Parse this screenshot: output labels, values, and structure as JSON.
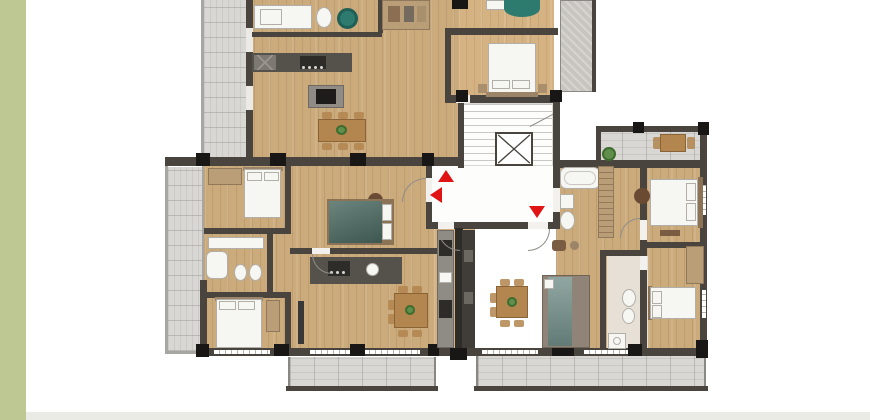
{
  "page": {
    "kind": "real-estate listing floor plan image",
    "visible_text": ""
  },
  "colors": {
    "pagebg": "#ffffff",
    "leftbar": "#bec893",
    "footer": "#ebebe6",
    "wood": "#cbaa7c",
    "balcony": "#d8d7d4",
    "wall": "#49453e",
    "rail": "#a8a6a2",
    "column": "#191715",
    "fixture": "#f6f6f3",
    "fixborder": "#b2afa9",
    "stair": "#c9c8c5",
    "hallfloor": "#fdfdfc",
    "teal": "#2d7a6e",
    "tealbed": "#4b6a61",
    "sofateal": "#74908a",
    "sofabase": "#8f8477",
    "table": "#b3854f",
    "wardrobe": "#b99e78",
    "plant": "#5f8f4a",
    "rugbrown": "#6b4a34",
    "arrow": "#e11414",
    "concrete": "#c8c5c0",
    "tile": "#e6e0d6",
    "kcounter": "#55514b",
    "kdark": "#2e2c29",
    "headboard": "#9b8468",
    "bedframe": "#8d7355"
  },
  "floorplan": {
    "type": "apartment-building-floor-plan",
    "cropped_at_top": true,
    "markers": {
      "entrance_arrows": [
        {
          "direction": "up"
        },
        {
          "direction": "left"
        },
        {
          "direction": "down"
        }
      ]
    },
    "features": [
      "central-staircase",
      "elevator-shaft",
      "entry-hall",
      "top-left-balcony",
      "left-balcony",
      "bottom-left-balcony",
      "bottom-right-balcony",
      "top-right-balcony",
      "kitchens",
      "dining-tables",
      "beds",
      "sofas",
      "bathtubs",
      "toilets",
      "wardrobes",
      "plants"
    ]
  }
}
